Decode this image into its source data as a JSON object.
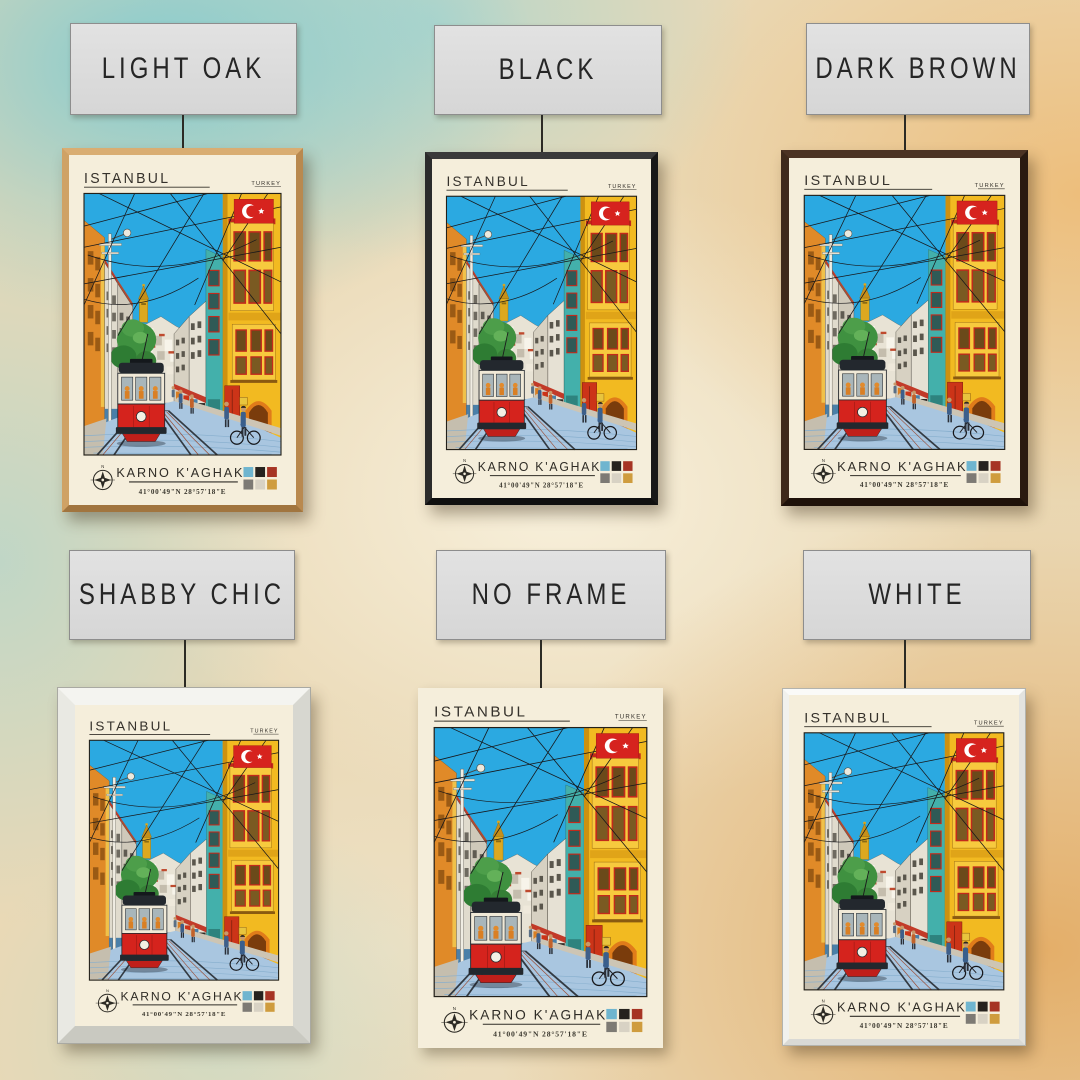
{
  "poster": {
    "title": "ISTANBUL",
    "country": "TURKEY",
    "subtitle": "KARNO K'AGHAK'",
    "coordinates": "41°00'49\"N 28°57'18\"E",
    "compass_label": "N",
    "palette": [
      "#6FB5CF",
      "#26221E",
      "#A63424",
      "#7D7A74",
      "#D8D2C4",
      "#CF9C3E"
    ],
    "scene": "Istanbul street with red tram, overhead wires, yellow and teal buildings, Galata tower, Turkish flag"
  },
  "variants": [
    {
      "label": "LIGHT OAK",
      "frame_color": "#C89A5E"
    },
    {
      "label": "BLACK",
      "frame_color": "#1F1F1F"
    },
    {
      "label": "DARK BROWN",
      "frame_color": "#372319"
    },
    {
      "label": "SHABBY CHIC",
      "frame_color": "#E9E9E5"
    },
    {
      "label": "NO FRAME",
      "frame_color": ""
    },
    {
      "label": "WHITE",
      "frame_color": "#EFEFED"
    }
  ],
  "colors": {
    "wall_teal": "#8CC9D2",
    "wall_orange": "#E89A44",
    "wall_cream": "#F3E9CE",
    "poster_background": "#F5EEDB",
    "sky": "#2BA9E1",
    "tram_red": "#D5231D",
    "flag_red": "#D6231E",
    "label_box": "#DCDCDC"
  }
}
